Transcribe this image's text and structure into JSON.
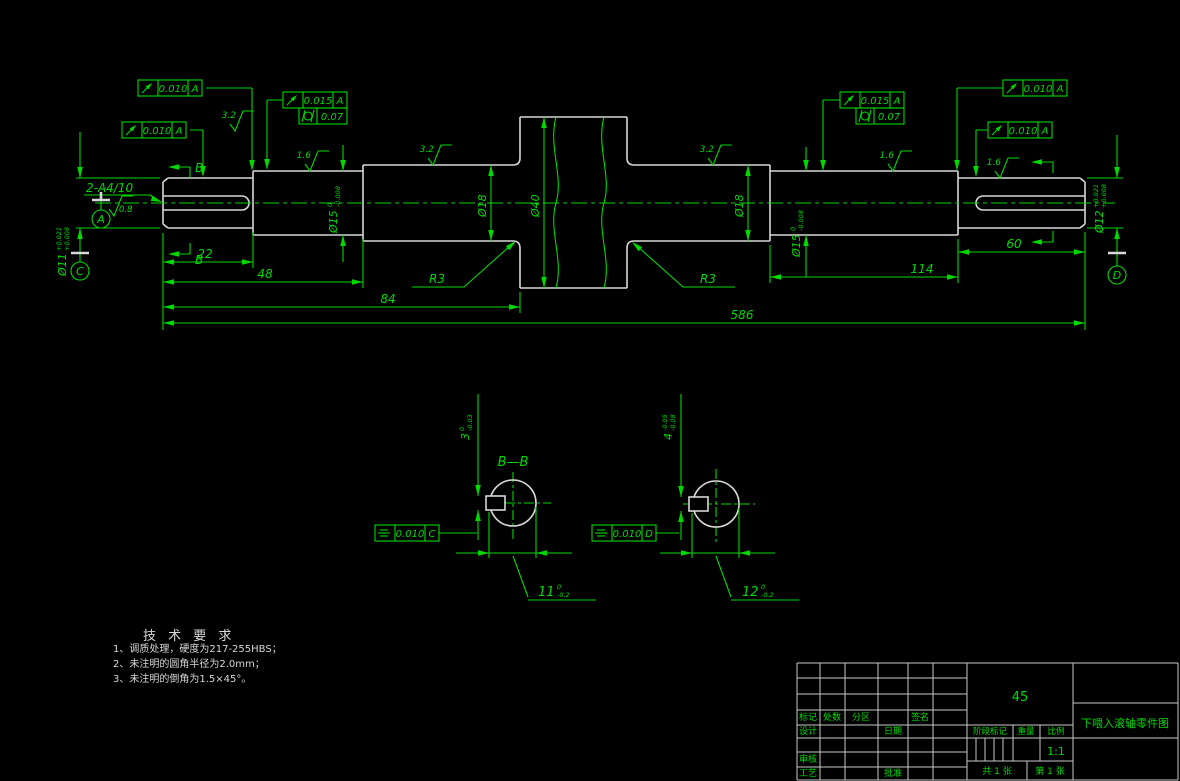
{
  "labels": {
    "section_title": "B—B",
    "cut_top": "B",
    "cut_bottom": "B",
    "keyway_note": "2-A4/10",
    "r3_left": "R3",
    "r3_right": "R3",
    "datum_a": "A",
    "datum_c": "C",
    "datum_d": "D"
  },
  "dims": {
    "len22": "22",
    "len48": "48",
    "len84": "84",
    "len586": "586",
    "len114": "114",
    "len60": "60",
    "dia18_left": "Ø18",
    "dia40": "Ø40",
    "dia18_right": "Ø18",
    "dia15_left": {
      "main": "Ø15",
      "sup": "0",
      "sub": "-0.008"
    },
    "dia15_right": {
      "main": "Ø15",
      "sup": "0",
      "sub": "-0.008"
    },
    "dia11_left": {
      "main": "Ø11",
      "sup": "+0.021",
      "sub": "+0.008"
    },
    "dia12_right": {
      "main": "Ø12",
      "sup": "+0.021",
      "sub": "+0.008"
    },
    "key_width_left": {
      "main": "3",
      "sup": "0",
      "sub": "-0.03"
    },
    "key_width_right": {
      "main": "4",
      "sup": "-0.05",
      "sub": "-0.08"
    },
    "key_depth_left": {
      "main": "11",
      "sup": "0",
      "sub": "-0.2"
    },
    "key_depth_right": {
      "main": "12",
      "sup": "0",
      "sub": "-0.2"
    }
  },
  "roughness": {
    "r1": "3.2",
    "r2": "1.6",
    "r3": "3.2",
    "r4": "3.2",
    "r5": "1.6",
    "r6": "1.6",
    "r7": "0.8"
  },
  "fcf": {
    "f1": {
      "symbol": "circular-runout",
      "val": "0.010",
      "datum": "A"
    },
    "f2": {
      "symbol": "circular-runout",
      "val": "0.010",
      "datum": "A"
    },
    "f3": {
      "symbol": "circular-runout",
      "val": "0.015",
      "datum": "A"
    },
    "f4": {
      "symbol": "cylindricity",
      "val": "0.07"
    },
    "f5": {
      "symbol": "circular-runout",
      "val": "0.015",
      "datum": "A"
    },
    "f6": {
      "symbol": "cylindricity",
      "val": "0.07"
    },
    "f7": {
      "symbol": "circular-runout",
      "val": "0.010",
      "datum": "A"
    },
    "f8": {
      "symbol": "circular-runout",
      "val": "0.010",
      "datum": "A"
    },
    "f9": {
      "symbol": "symmetry",
      "val": "0.010",
      "datum": "C"
    },
    "f10": {
      "symbol": "symmetry",
      "val": "0.010",
      "datum": "D"
    }
  },
  "tech": {
    "title": "技 术 要 求",
    "line1": "1、调质处理，硬度为217-255HBS；",
    "line2": "2、未注明的圆角半径为2.0mm；",
    "line3": "3、未注明的倒角为1.5×45°。"
  },
  "titleblock": {
    "material": "45",
    "scale_value": "1:1",
    "part_title": "下喂入滚轴零件图",
    "mark": "标记",
    "count": "处数",
    "zone": "分区",
    "sign": "签名",
    "design": "设计",
    "date": "日期",
    "audit": "审核",
    "process": "工艺",
    "approve": "批准",
    "stage": "阶段标记",
    "weight": "重量",
    "scale": "比例",
    "sheets": "共 1 张",
    "sheet_no": "第 1 张"
  },
  "colors": {
    "line_green": "#00d900",
    "outline_white": "#d8d8d8",
    "background": "#000000"
  }
}
